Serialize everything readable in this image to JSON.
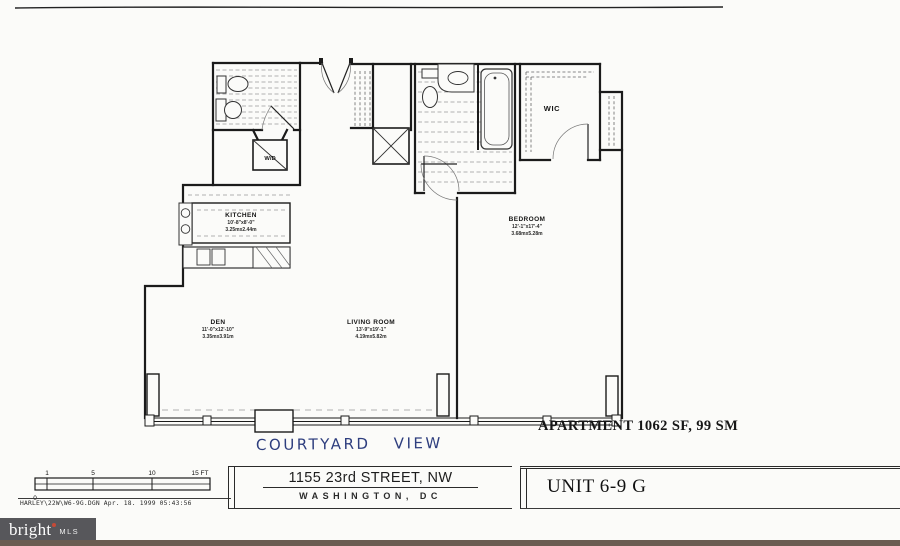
{
  "plan": {
    "rooms": {
      "kitchen": {
        "name": "KITCHEN",
        "dims_ft": "10'-8\"x8'-0\"",
        "dims_m": "3.25mx2.44m"
      },
      "den": {
        "name": "DEN",
        "dims_ft": "11'-0\"x12'-10\"",
        "dims_m": "3.35mx3.91m"
      },
      "living_room": {
        "name": "LIVING ROOM",
        "dims_ft": "13'-9\"x19'-1\"",
        "dims_m": "4.19mx5.82m"
      },
      "bedroom": {
        "name": "BEDROOM",
        "dims_ft": "12'-1\"x17'-4\"",
        "dims_m": "3.68mx5.28m"
      },
      "wic": {
        "name": "WIC"
      },
      "washer_dryer": {
        "name": "W/D"
      }
    },
    "annotations": {
      "area_label": "APARTMENT 1062 SF, 99 SM",
      "view_note": "COURTYARD  VIEW"
    }
  },
  "scale_bar": {
    "ticks": [
      "1",
      "5",
      "10",
      "15 FT"
    ],
    "origin": "0"
  },
  "plot_stamp": "HARLEY\\22W\\W6-9G.DGN  Apr. 18. 1999  05:43:56",
  "title_block": {
    "address_line1": "1155 23rd STREET, NW",
    "address_line2": "WASHINGTON, DC",
    "unit_label": "UNIT 6-9 G"
  },
  "footer": {
    "brand": "bright",
    "brand_suffix": "MLS",
    "logo_bg": "#57575b",
    "strip_color": "#6b5d52",
    "accent": "#c64a37",
    "ink": "#1b1b1b",
    "note_ink": "#2e3e7e"
  }
}
